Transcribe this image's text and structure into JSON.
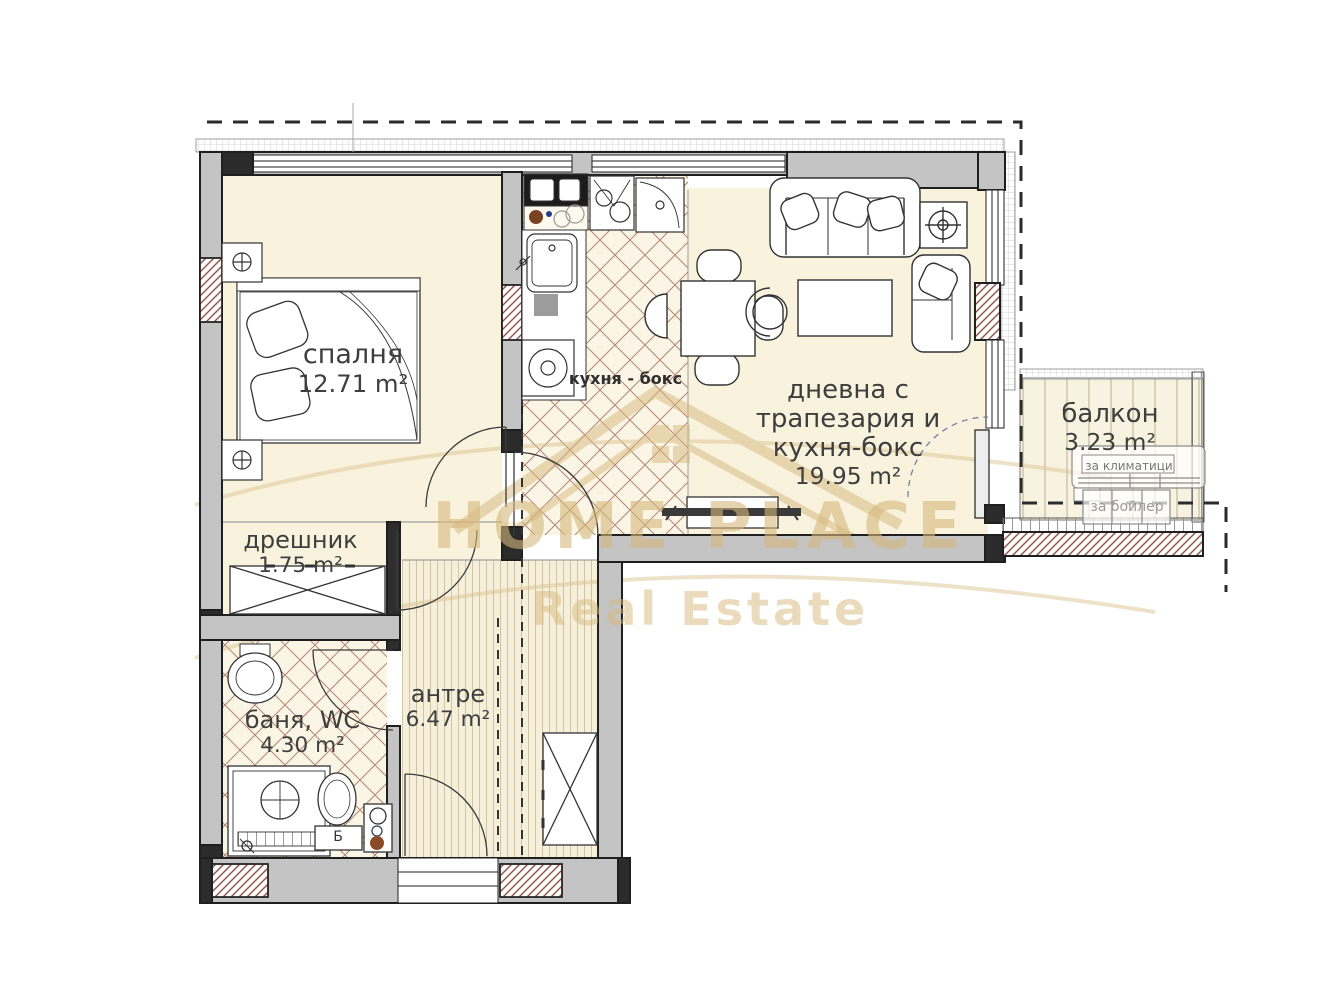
{
  "watermark": {
    "brand_line1": "HOME PLACE",
    "brand_line2": "Real Estate",
    "color": "#d5b87c"
  },
  "rooms": {
    "bedroom": {
      "name": "спалня",
      "area": "12.71 m²"
    },
    "living": {
      "lines": [
        "дневна с",
        "трапезария и",
        "кухня-бокс"
      ],
      "area": "19.95 m²"
    },
    "balcony": {
      "name": "балкон",
      "area": "3.23 m²"
    },
    "closet": {
      "name": "дрешник",
      "area": "1.75 m²"
    },
    "bath": {
      "name": "баня, WC",
      "area": "4.30 m²"
    },
    "hall": {
      "name": "антре",
      "area": "6.47 m²"
    }
  },
  "annotations": {
    "kitchen_label": "кухня - бокс",
    "ac_label": "за климатици",
    "boiler_label": "за бойлер",
    "toilet_cistern_label": "Б"
  },
  "colors": {
    "wall_gray": "#c4c4c4",
    "floor_cream": "#f9f3de",
    "hatch_red": "#96554b",
    "watermark_gold": "#d5b87c"
  }
}
